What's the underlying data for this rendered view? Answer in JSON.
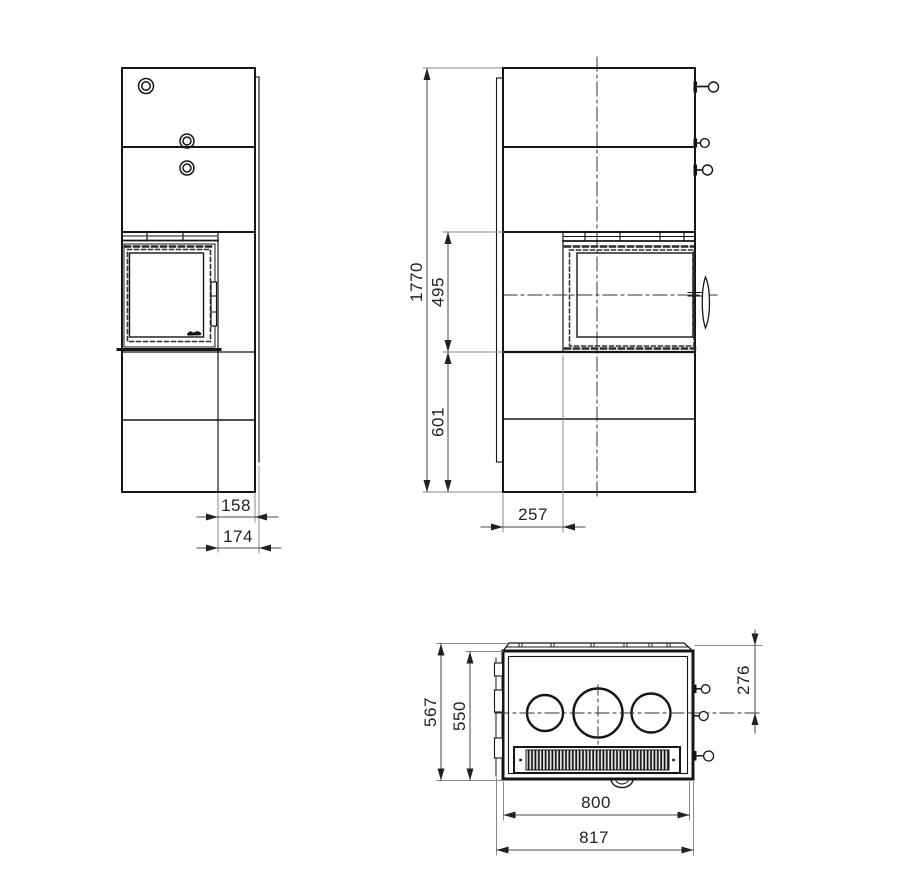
{
  "drawing": {
    "front_view": {
      "dims": {
        "d158": "158",
        "d174": "174"
      }
    },
    "side_view": {
      "dims": {
        "d1770": "1770",
        "d495": "495",
        "d601": "601",
        "d257": "257"
      }
    },
    "top_view": {
      "dims": {
        "d567": "567",
        "d550": "550",
        "d276": "276",
        "d800": "800",
        "d817": "817"
      }
    },
    "icons": {
      "brand_logo": "script-logo-mark"
    }
  }
}
